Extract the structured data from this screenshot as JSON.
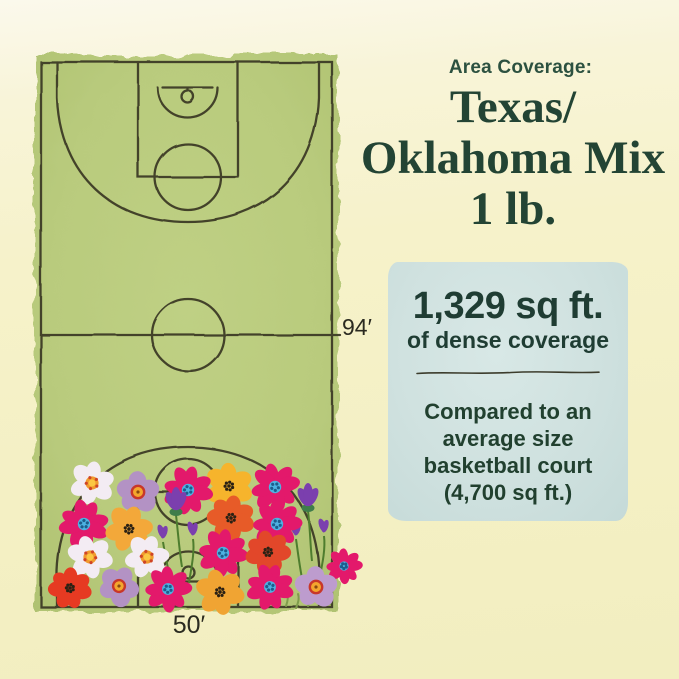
{
  "header": {
    "kicker": "Area Coverage:",
    "title_lines": [
      "Texas/",
      "Oklahoma Mix",
      "1 lb."
    ]
  },
  "court": {
    "length_label": "94′",
    "width_label": "50′"
  },
  "info_box": {
    "coverage_value": "1,329 sq ft.",
    "coverage_caption": "of dense coverage",
    "comparison_lines": [
      "Compared to an",
      "average size",
      "basketball court",
      "(4,700 sq ft.)"
    ]
  },
  "colors": {
    "background": "#f5f1c6",
    "court_green": "#b9cb7d",
    "court_line": "#3d3b25",
    "info_box_bg": "#cfe1df",
    "heading_green": "#2c5140",
    "title_green": "#234434",
    "label_dark": "#2a2a20",
    "flower_magenta": "#e3196b",
    "flower_red": "#e63a22",
    "flower_orange_red": "#e75b28",
    "flower_yellow": "#f6b42c",
    "flower_white": "#f3ecf3",
    "flower_lavender": "#b392c4",
    "flower_purple": "#7b3fae",
    "center_blue": "#4db2e2",
    "stem_green": "#4e7d2e"
  },
  "illustration": {
    "flowers": [
      {
        "type": "daisy",
        "x": 92,
        "y": 483,
        "r": 22,
        "rot": 10
      },
      {
        "type": "mallow",
        "x": 138,
        "y": 492,
        "r": 22,
        "rot": 0
      },
      {
        "type": "golden",
        "x": 229,
        "y": 486,
        "r": 23,
        "rot": 0
      },
      {
        "type": "cosmos",
        "x": 188,
        "y": 490,
        "r": 23,
        "rot": 15
      },
      {
        "type": "cosmos",
        "x": 275,
        "y": 487,
        "r": 23,
        "rot": -10
      },
      {
        "type": "crocus",
        "x": 176,
        "y": 509,
        "stem": 58,
        "sx": 6
      },
      {
        "type": "crocus",
        "x": 308,
        "y": 505,
        "stem": 56,
        "sx": 4
      },
      {
        "type": "bud",
        "x": 163,
        "y": 536,
        "stem": 44,
        "sx": 8
      },
      {
        "type": "bud",
        "x": 193,
        "y": 533,
        "stem": 50,
        "sx": -4
      },
      {
        "type": "bud",
        "x": 296,
        "y": 533,
        "stem": 50,
        "sx": 7
      },
      {
        "type": "bud",
        "x": 324,
        "y": 530,
        "stem": 56,
        "sx": -6
      },
      {
        "type": "poppy",
        "x": 231,
        "y": 518,
        "r": 23,
        "rot": 12,
        "color": "#e75b28"
      },
      {
        "type": "cosmos",
        "x": 84,
        "y": 524,
        "r": 23,
        "rot": 30
      },
      {
        "type": "golden",
        "x": 129,
        "y": 529,
        "r": 23,
        "rot": 20,
        "color": "#f3a83a"
      },
      {
        "type": "cosmos",
        "x": 277,
        "y": 524,
        "r": 23,
        "rot": 0
      },
      {
        "type": "daisy",
        "x": 90,
        "y": 557,
        "r": 22,
        "rot": -15
      },
      {
        "type": "daisy",
        "x": 147,
        "y": 557,
        "r": 22,
        "rot": 20
      },
      {
        "type": "cosmos",
        "x": 223,
        "y": 553,
        "r": 23,
        "rot": 10
      },
      {
        "type": "poppy",
        "x": 268,
        "y": 552,
        "r": 22,
        "rot": -8,
        "color": "#e2472a"
      },
      {
        "type": "cosmos",
        "x": 344,
        "y": 566,
        "r": 17,
        "rot": 0
      },
      {
        "type": "poppy",
        "x": 70,
        "y": 588,
        "r": 21,
        "rot": 5,
        "color": "#e63a22"
      },
      {
        "type": "mallow",
        "x": 119,
        "y": 586,
        "r": 21,
        "rot": 30
      },
      {
        "type": "cosmos",
        "x": 168,
        "y": 589,
        "r": 22,
        "rot": 0
      },
      {
        "type": "golden",
        "x": 220,
        "y": 592,
        "r": 23,
        "rot": -15,
        "color": "#f0a433"
      },
      {
        "type": "cosmos",
        "x": 270,
        "y": 587,
        "r": 22,
        "rot": 20
      },
      {
        "type": "mallow",
        "x": 316,
        "y": 587,
        "r": 22,
        "rot": 0,
        "color": "#bd9cce"
      }
    ]
  }
}
